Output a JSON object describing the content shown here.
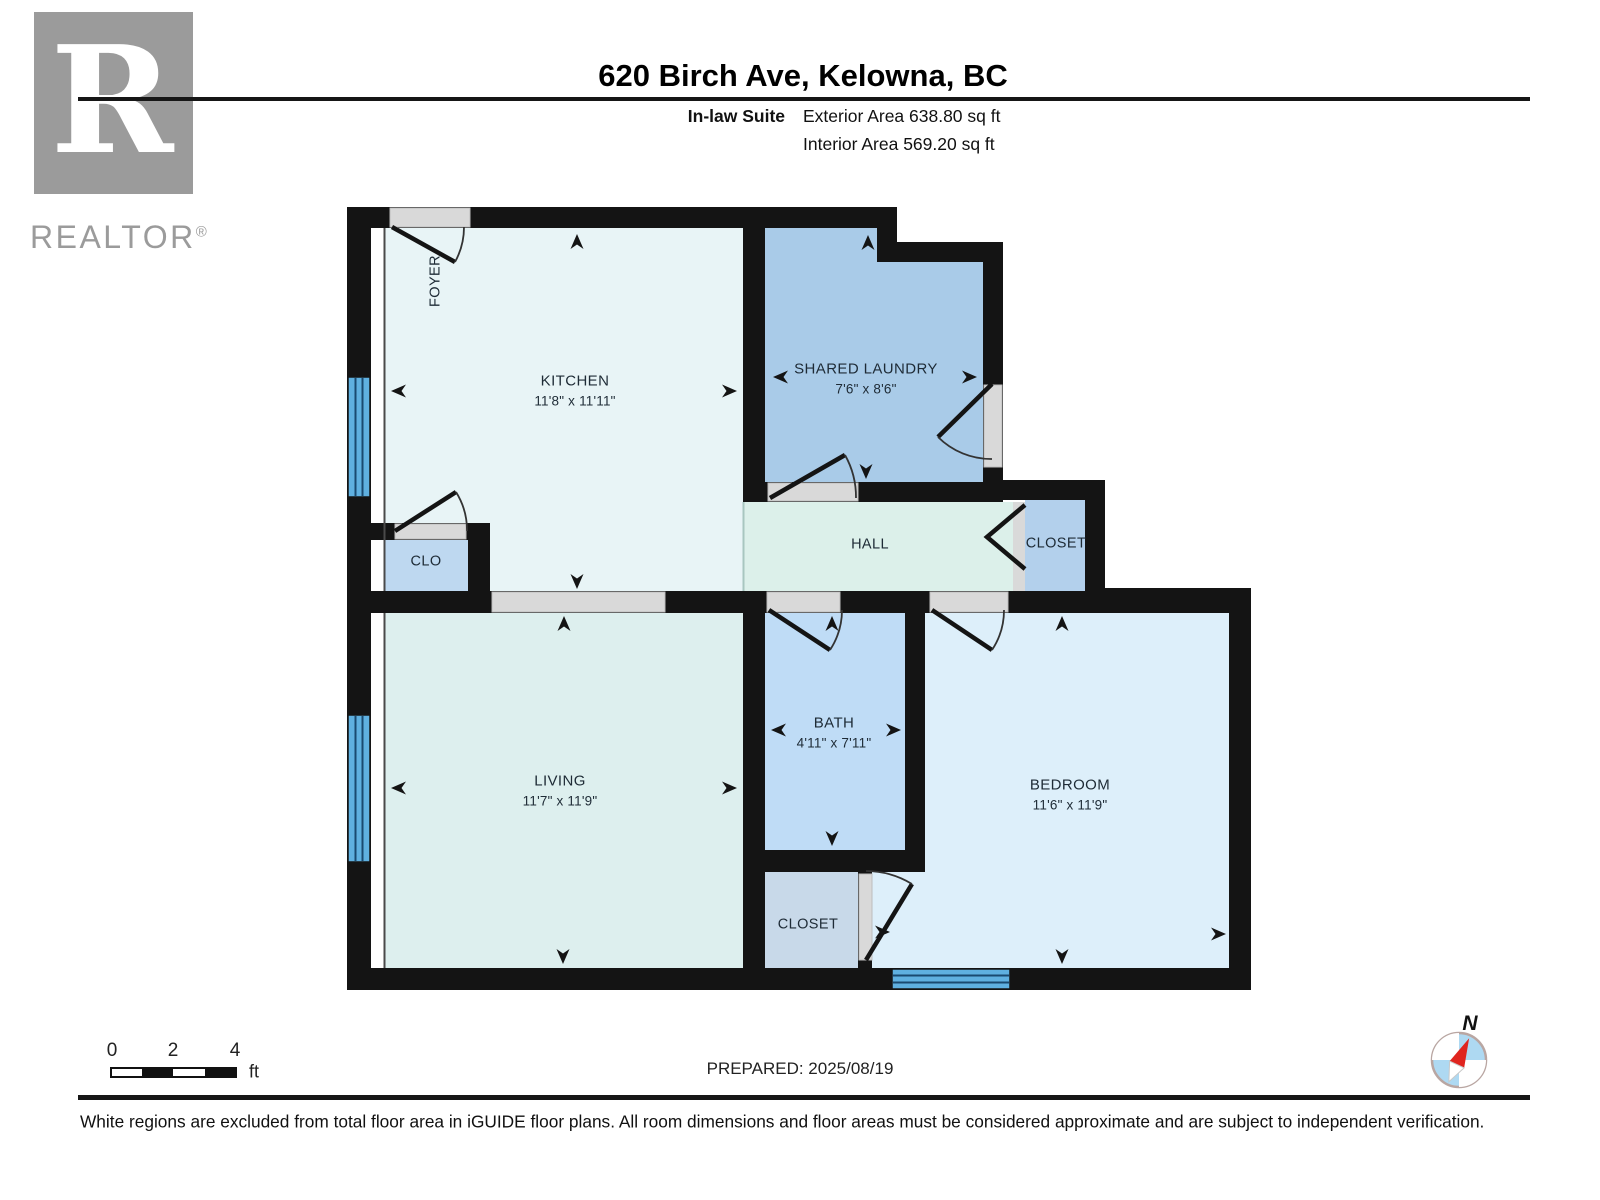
{
  "header": {
    "title": "620 Birch Ave, Kelowna, BC",
    "suite_label": "In-law Suite",
    "exterior_area": "Exterior Area 638.80 sq ft",
    "interior_area": "Interior Area 569.20 sq ft"
  },
  "branding": {
    "logo_letter": "R",
    "name": "REALTOR",
    "reg": "®"
  },
  "rooms": {
    "kitchen": {
      "name": "KITCHEN",
      "dims": "11'8\" x 11'11\""
    },
    "laundry": {
      "name": "SHARED LAUNDRY",
      "dims": "7'6\" x 8'6\""
    },
    "living": {
      "name": "LIVING",
      "dims": "11'7\" x 11'9\""
    },
    "bath": {
      "name": "BATH",
      "dims": "4'11\" x 7'11\""
    },
    "bedroom": {
      "name": "BEDROOM",
      "dims": "11'6\" x 11'9\""
    },
    "hall": {
      "name": "HALL"
    },
    "closet_hall": {
      "name": "CLOSET"
    },
    "closet_bedroom": {
      "name": "CLOSET"
    },
    "clo": {
      "name": "CLO"
    },
    "foyer": {
      "name": "FOYER"
    }
  },
  "scale_bar": {
    "tick0": "0",
    "tick2": "2",
    "tick4": "4",
    "unit": "ft"
  },
  "compass": {
    "north": "N"
  },
  "footer": {
    "prepared": "PREPARED: 2025/08/19",
    "disclaimer": "White regions are excluded from total floor area in iGUIDE floor plans. All room dimensions and floor areas must be considered approximate and are subject to independent verification."
  },
  "colors": {
    "wall": "#141414",
    "window_blue": "#5fb0e0",
    "window_line": "#1a4a70",
    "kitchen_fill": "#e8f4f6",
    "living_fill": "#ddefee",
    "hall_fill": "#dcf0ea",
    "laundry_fill": "#a9cbe8",
    "bath_fill": "#bfdcf6",
    "bedroom_fill": "#ddeffa",
    "closet_fill": "#b3d0ec",
    "clo_fill": "#bed8f0",
    "bedroom_closet_fill": "#c8d9e9",
    "opening_gray": "#d9d9d9",
    "compass_red": "#e0251f",
    "logo_gray": "#9b9b9b"
  }
}
